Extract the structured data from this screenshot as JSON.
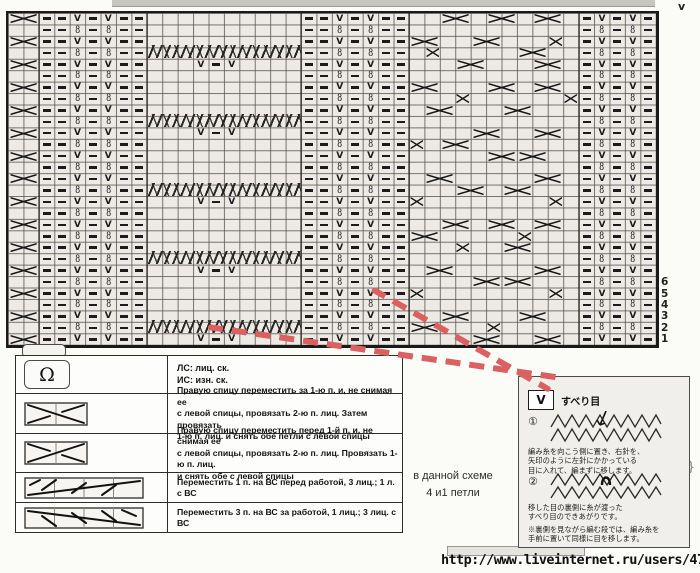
{
  "colors": {
    "accent_red": "#db6161",
    "chart_fill": "#edeae5",
    "grid_line": "#58554e",
    "symbol": "#191919",
    "panel_bg": "#f0efeb"
  },
  "chart": {
    "cols": 42,
    "rows": 29,
    "cell_w": 15.43,
    "cell_h": 11.45,
    "corner_mark": "v",
    "purl_cols": [
      2,
      3,
      5,
      7,
      8,
      19,
      20,
      22,
      24,
      25,
      37,
      39,
      41
    ],
    "chain_cols": [
      4,
      6,
      21,
      23,
      38,
      40
    ],
    "chain_glyph_odd": "V",
    "chain_glyph_even": "8",
    "edge_x": {
      "col": 0,
      "span": 2,
      "rows": [
        1,
        3,
        5,
        7,
        9,
        11,
        13,
        15,
        17,
        19,
        21,
        23,
        25,
        27,
        29
      ]
    },
    "braids": {
      "col": 9,
      "span": 10,
      "rows": [
        4,
        10,
        16,
        22,
        28
      ]
    },
    "after_braid": {
      "rows": [
        5,
        11,
        17,
        23,
        29
      ],
      "marks": [
        {
          "col": 12,
          "t": "v"
        },
        {
          "col": 13,
          "t": "-"
        },
        {
          "col": 14,
          "t": "v"
        }
      ]
    },
    "heavy_cols": [
      2,
      9,
      19,
      26,
      37
    ],
    "x_marks": [
      [
        1,
        28,
        2
      ],
      [
        1,
        31,
        2
      ],
      [
        1,
        34,
        2
      ],
      [
        3,
        26,
        2
      ],
      [
        3,
        30,
        2
      ],
      [
        3,
        35,
        1
      ],
      [
        4,
        27,
        1
      ],
      [
        4,
        33,
        2
      ],
      [
        5,
        29,
        2
      ],
      [
        5,
        34,
        2
      ],
      [
        7,
        26,
        2
      ],
      [
        7,
        31,
        2
      ],
      [
        7,
        34,
        2
      ],
      [
        8,
        29,
        1
      ],
      [
        8,
        36,
        1
      ],
      [
        9,
        27,
        2
      ],
      [
        9,
        32,
        2
      ],
      [
        11,
        30,
        2
      ],
      [
        11,
        34,
        2
      ],
      [
        12,
        26,
        1
      ],
      [
        12,
        28,
        2
      ],
      [
        13,
        31,
        2
      ],
      [
        13,
        33,
        2
      ],
      [
        15,
        27,
        2
      ],
      [
        15,
        34,
        2
      ],
      [
        16,
        29,
        2
      ],
      [
        16,
        32,
        2
      ],
      [
        17,
        26,
        1
      ],
      [
        17,
        35,
        1
      ],
      [
        19,
        28,
        2
      ],
      [
        19,
        31,
        2
      ],
      [
        19,
        34,
        2
      ],
      [
        20,
        26,
        2
      ],
      [
        20,
        33,
        1
      ],
      [
        21,
        29,
        1
      ],
      [
        21,
        32,
        2
      ],
      [
        23,
        27,
        2
      ],
      [
        23,
        34,
        2
      ],
      [
        24,
        30,
        2
      ],
      [
        24,
        32,
        2
      ],
      [
        25,
        26,
        1
      ],
      [
        25,
        35,
        1
      ],
      [
        27,
        28,
        2
      ],
      [
        27,
        33,
        2
      ],
      [
        28,
        26,
        2
      ],
      [
        28,
        31,
        1
      ],
      [
        29,
        30,
        2
      ],
      [
        29,
        34,
        2
      ]
    ],
    "row_numbers": [
      {
        "label": "6",
        "row": 24
      },
      {
        "label": "5",
        "row": 25
      },
      {
        "label": "4",
        "row": 26
      },
      {
        "label": "3",
        "row": 27
      },
      {
        "label": "2",
        "row": 28
      },
      {
        "label": "1",
        "row": 29
      }
    ]
  },
  "legend": {
    "rows": [
      {
        "symbol": "loop-stitch",
        "symbol_glyph": "Ω",
        "text": "ЛС: лиц. ск.\nИС: изн. ск."
      },
      {
        "symbol": "cross-2-back",
        "text": "Правую спицу переместить за 1-ю п. и, не снимая ее\nс левой спицы, провязать 2-ю п. лиц. Затем провязать\n1-ю п. лиц. и снять обе петли с левой спицы"
      },
      {
        "symbol": "cross-2-front",
        "text": "Правую спицу переместить перед 1-й п. и, не снимая ее\nс левой спицы, провязать 2-ю п. лиц. Провязать 1-ю п. лиц.\nи снять обе с левой спицы"
      },
      {
        "symbol": "cable-1-over-3-front",
        "text": "Переместить 1 п. на ВС перед работой, 3 лиц.; 1 л. с ВС"
      },
      {
        "symbol": "cable-3-over-1-back",
        "text": "Переместить 3 п. на ВС за работой, 1 лиц.; 3 лиц. с ВС"
      }
    ]
  },
  "note": {
    "text": "в данной схеме\n4 и1 петли"
  },
  "panel": {
    "symbol_glyph": "V",
    "title": "すべり目",
    "step1": {
      "num": "①",
      "text": "編み糸を向こう側に置き、右針を、\n矢印のように左針にかかっている\n目に入れて、編まずに移します。"
    },
    "step2": {
      "num": "②",
      "text": "移した目の裏側に糸が渡った\nすべり目のできあがりです。"
    },
    "footnote": "※裏側を見ながら編む段では、編み糸を\n手前に置いて同様に目を移します。"
  },
  "footer": {
    "url": "http://www.liveinternet.ru/users/4753654/"
  }
}
